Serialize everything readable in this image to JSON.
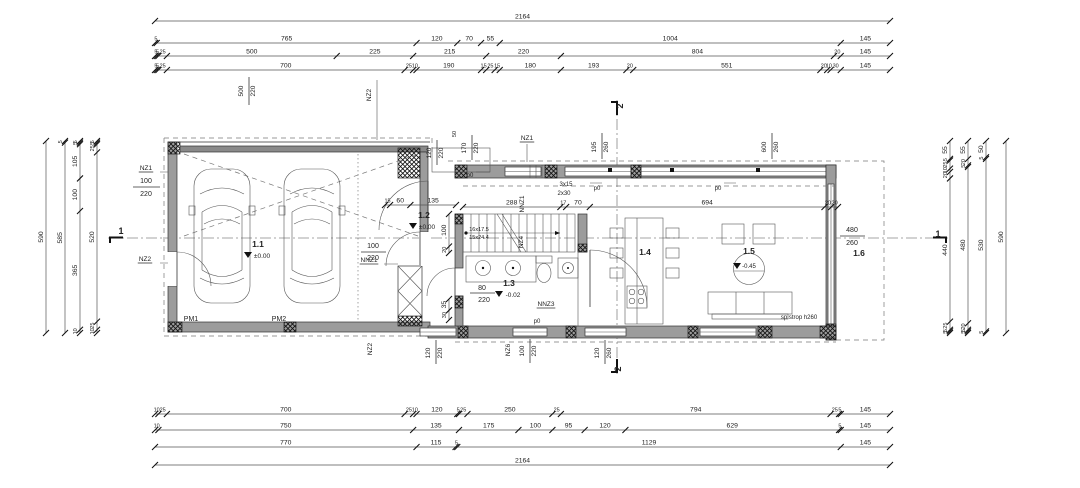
{
  "colors": {
    "wall_fill": "#9c9c9c",
    "door_band": "#8a8a8a",
    "line": "#333333",
    "hatch": "#111111",
    "background": "#ffffff"
  },
  "dimensions": {
    "horizontal": [
      {
        "y": 21,
        "x1": 155,
        "x2": 890,
        "values": [
          2164
        ]
      },
      {
        "y": 43,
        "x1": 155,
        "x2": 890,
        "values": [
          5,
          765,
          120,
          70,
          55,
          1004,
          145
        ]
      },
      {
        "y": 56,
        "x1": 155,
        "x2": 890,
        "values": [
          5,
          5,
          25,
          500,
          225,
          215,
          220,
          804,
          20,
          145
        ]
      },
      {
        "y": 70,
        "x1": 155,
        "x2": 890,
        "values": [
          5,
          5,
          25,
          700,
          25,
          10,
          190,
          15,
          25,
          15,
          180,
          193,
          20,
          551,
          20,
          10,
          30,
          145
        ]
      },
      {
        "y": 414,
        "x1": 155,
        "x2": 890,
        "values": [
          10,
          25,
          700,
          25,
          10,
          120,
          5,
          25,
          250,
          25,
          794,
          25,
          5,
          145
        ]
      },
      {
        "y": 430,
        "x1": 155,
        "x2": 890,
        "values": [
          10,
          750,
          135,
          175,
          100,
          95,
          120,
          629,
          5,
          145
        ]
      },
      {
        "y": 447,
        "x1": 155,
        "x2": 890,
        "values": [
          770,
          115,
          5,
          1129,
          145
        ]
      },
      {
        "y": 465,
        "x1": 155,
        "x2": 890,
        "values": [
          2164
        ]
      },
      {
        "y": 207,
        "x1": 463,
        "x2": 838,
        "values": [
          288,
          17,
          70,
          694,
          20,
          20
        ]
      },
      {
        "y": 205,
        "x1": 385,
        "x2": 456,
        "values": [
          15,
          60,
          135
        ]
      }
    ],
    "vertical": [
      {
        "x": 46,
        "y1": 141,
        "y2": 333,
        "values": [
          590
        ]
      },
      {
        "x": 65,
        "y1": 141,
        "y2": 333,
        "values": [
          5,
          585
        ]
      },
      {
        "x": 80,
        "y1": 141,
        "y2": 333,
        "values": [
          5,
          5,
          105,
          100,
          365,
          10
        ]
      },
      {
        "x": 97,
        "y1": 141,
        "y2": 333,
        "values": [
          5,
          5,
          25,
          520,
          25,
          10
        ]
      },
      {
        "x": 950,
        "y1": 141,
        "y2": 333,
        "values": [
          55,
          5,
          25,
          10,
          20,
          440,
          25,
          5,
          5
        ]
      },
      {
        "x": 968,
        "y1": 141,
        "y2": 333,
        "values": [
          55,
          20,
          5,
          480,
          20,
          5,
          5
        ]
      },
      {
        "x": 986,
        "y1": 141,
        "y2": 333,
        "values": [
          50,
          5,
          530,
          5
        ]
      },
      {
        "x": 1006,
        "y1": 141,
        "y2": 333,
        "values": [
          590
        ]
      },
      {
        "x": 449,
        "y1": 214,
        "y2": 253,
        "values": [
          100,
          20
        ]
      },
      {
        "x": 449,
        "y1": 299,
        "y2": 320,
        "values": [
          35,
          30
        ]
      }
    ]
  },
  "labels": [
    {
      "t": "NZ1",
      "x": 146,
      "y": 170,
      "u": 1,
      "n": "opening-label-nz1-left"
    },
    {
      "t": "100",
      "x": 146,
      "y": 183,
      "fs": 7
    },
    {
      "t": "220",
      "x": 146,
      "y": 196,
      "fs": 7
    },
    {
      "t": "NZ2",
      "x": 145,
      "y": 261,
      "u": 1,
      "n": "opening-label-nz2-left"
    },
    {
      "t": "NZ2",
      "x": 371,
      "y": 95,
      "rot": 1,
      "n": "opening-label-nz2-top"
    },
    {
      "t": "500",
      "x": 243,
      "y": 91,
      "rot": 1
    },
    {
      "t": "220",
      "x": 255,
      "y": 91,
      "rot": 1
    },
    {
      "t": "120",
      "x": 431,
      "y": 153,
      "rot": 1
    },
    {
      "t": "220",
      "x": 443,
      "y": 153,
      "rot": 1
    },
    {
      "t": "50",
      "x": 456,
      "y": 134,
      "rot": 1,
      "fs": 5.5
    },
    {
      "t": "170",
      "x": 466,
      "y": 148,
      "rot": 1
    },
    {
      "t": "220",
      "x": 478,
      "y": 148,
      "rot": 1
    },
    {
      "t": "NZ1",
      "x": 527,
      "y": 140,
      "u": 1,
      "n": "opening-label-nz1-top"
    },
    {
      "t": "195",
      "x": 596,
      "y": 147,
      "rot": 1
    },
    {
      "t": "260",
      "x": 608,
      "y": 147,
      "rot": 1
    },
    {
      "t": "600",
      "x": 766,
      "y": 147,
      "rot": 1
    },
    {
      "t": "260",
      "x": 778,
      "y": 147,
      "rot": 1
    },
    {
      "t": "p0",
      "x": 470,
      "y": 177,
      "fs": 6,
      "n": "level-mark"
    },
    {
      "t": "p0",
      "x": 597,
      "y": 190,
      "fs": 6,
      "n": "level-mark"
    },
    {
      "t": "p0",
      "x": 718,
      "y": 190,
      "fs": 6,
      "n": "level-mark"
    },
    {
      "t": "p0",
      "x": 537,
      "y": 323,
      "fs": 6,
      "n": "level-mark"
    },
    {
      "t": "NNZ1",
      "x": 524,
      "y": 204,
      "rot": 1,
      "fs": 6.5,
      "n": "opening-label-nnz1-mid"
    },
    {
      "t": "NZ4",
      "x": 523,
      "y": 242,
      "rot": 1,
      "fs": 6.5,
      "n": "opening-label-nz4"
    },
    {
      "t": "16x17.5",
      "x": 479,
      "y": 231,
      "fs": 5.5,
      "n": "stair-note"
    },
    {
      "t": "15x24.4",
      "x": 479,
      "y": 239,
      "fs": 5.5,
      "n": "stair-note"
    },
    {
      "t": "3x15",
      "x": 566,
      "y": 186,
      "fs": 6,
      "n": "step-note"
    },
    {
      "t": "2x30",
      "x": 564,
      "y": 195,
      "fs": 6,
      "n": "step-note"
    },
    {
      "t": "1.1",
      "x": 258,
      "y": 247,
      "b": 1,
      "fs": 8.5,
      "n": "room-label-garage"
    },
    {
      "t": "±0.00",
      "x": 262,
      "y": 258,
      "fs": 6.5,
      "n": "room-level"
    },
    {
      "t": "1.2",
      "x": 424,
      "y": 218,
      "b": 1,
      "fs": 8.5,
      "n": "room-label-entry"
    },
    {
      "t": "±0.00",
      "x": 427,
      "y": 229,
      "fs": 6.5,
      "n": "room-level"
    },
    {
      "t": "1.3",
      "x": 509,
      "y": 286,
      "b": 1,
      "fs": 8.5,
      "n": "room-label-bath"
    },
    {
      "t": "-0.02",
      "x": 513,
      "y": 297,
      "fs": 6.5,
      "n": "room-level"
    },
    {
      "t": "80",
      "x": 482,
      "y": 290,
      "fs": 7
    },
    {
      "t": "220",
      "x": 484,
      "y": 302,
      "fs": 7
    },
    {
      "t": "NNZ3",
      "x": 546,
      "y": 306,
      "u": 1,
      "n": "opening-label-nnz3"
    },
    {
      "t": "1.4",
      "x": 645,
      "y": 255,
      "b": 1,
      "fs": 8.5,
      "n": "room-label-dining"
    },
    {
      "t": "1.5",
      "x": 749,
      "y": 254,
      "b": 1,
      "fs": 8.5,
      "n": "room-label-living"
    },
    {
      "t": "-0.45",
      "x": 749,
      "y": 268,
      "fs": 6,
      "n": "room-level"
    },
    {
      "t": "1.6",
      "x": 859,
      "y": 256,
      "b": 1,
      "fs": 8.5,
      "n": "room-label-terrace"
    },
    {
      "t": "480",
      "x": 852,
      "y": 232,
      "fs": 7
    },
    {
      "t": "260",
      "x": 852,
      "y": 245,
      "fs": 7
    },
    {
      "t": "NNZ1",
      "x": 369,
      "y": 262,
      "u": 1,
      "n": "opening-label-nnz1"
    },
    {
      "t": "PM1",
      "x": 191,
      "y": 321,
      "fs": 7,
      "n": "parking-label-1"
    },
    {
      "t": "PM2",
      "x": 279,
      "y": 321,
      "fs": 7,
      "n": "parking-label-2"
    },
    {
      "t": "sp.strop h260",
      "x": 799,
      "y": 319,
      "fs": 6,
      "n": "ceiling-note"
    },
    {
      "t": "120",
      "x": 430,
      "y": 353,
      "rot": 1
    },
    {
      "t": "220",
      "x": 442,
      "y": 353,
      "rot": 1
    },
    {
      "t": "NZ2",
      "x": 372,
      "y": 349,
      "rot": 1,
      "n": "opening-label-nz2-bottom"
    },
    {
      "t": "NZ6",
      "x": 510,
      "y": 350,
      "rot": 1,
      "n": "opening-label-nz6"
    },
    {
      "t": "100",
      "x": 524,
      "y": 351,
      "rot": 1
    },
    {
      "t": "220",
      "x": 536,
      "y": 351,
      "rot": 1
    },
    {
      "t": "120",
      "x": 599,
      "y": 353,
      "rot": 1
    },
    {
      "t": "260",
      "x": 611,
      "y": 353,
      "rot": 1
    },
    {
      "t": "1",
      "x": 121,
      "y": 234,
      "b": 1,
      "fs": 9,
      "n": "section-mark-1-left"
    },
    {
      "t": "1",
      "x": 938,
      "y": 237,
      "b": 1,
      "fs": 9,
      "n": "section-mark-1-right"
    },
    {
      "t": "2",
      "x": 623,
      "y": 106,
      "b": 1,
      "fs": 9,
      "rot": 1,
      "n": "section-mark-2-top"
    },
    {
      "t": "2",
      "x": 621,
      "y": 369,
      "b": 1,
      "fs": 9,
      "rot": 1,
      "n": "section-mark-2-bottom"
    },
    {
      "t": "100",
      "x": 373,
      "y": 248,
      "fs": 7
    },
    {
      "t": "220",
      "x": 373,
      "y": 260,
      "fs": 7
    }
  ]
}
